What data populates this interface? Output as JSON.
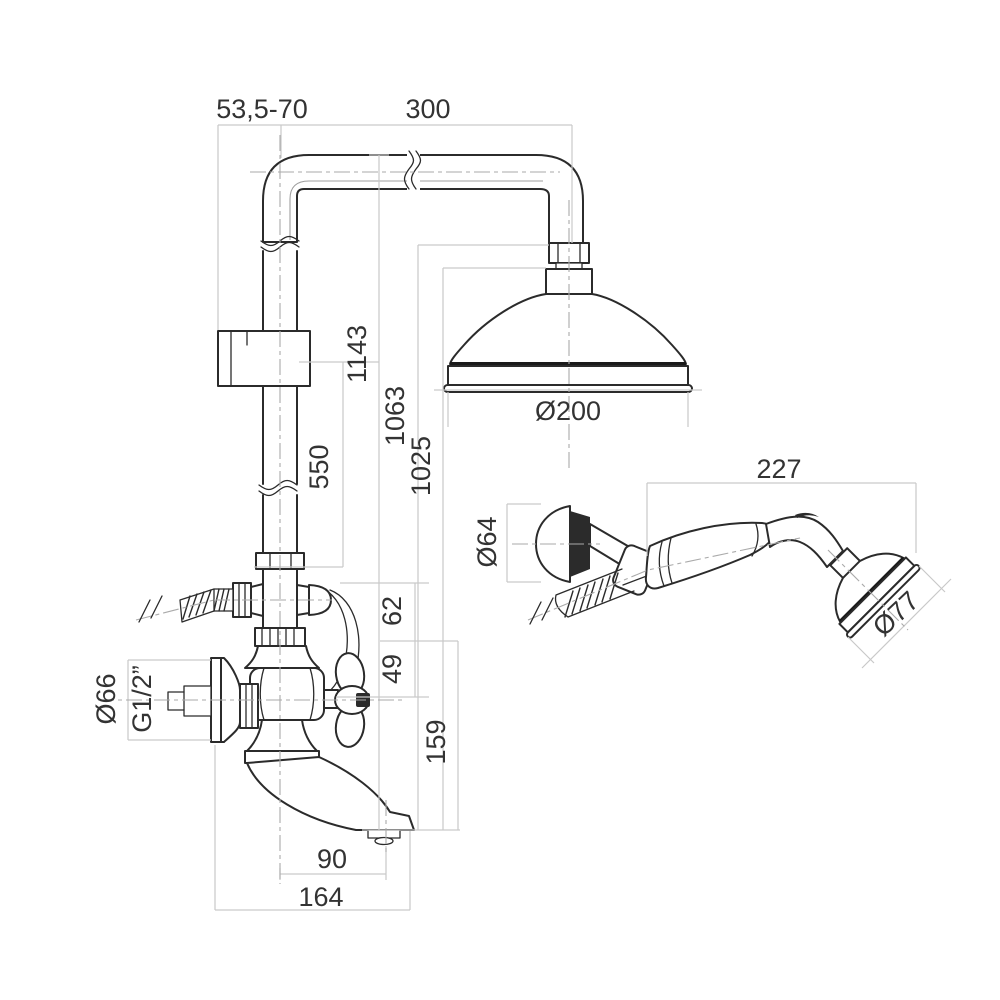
{
  "drawing": {
    "kind": "shower column technical dimension drawing",
    "background": "#ffffff",
    "stroke_color": "#2b2b2b",
    "dimension_line_color": "#c9c9c9",
    "centerline_color": "#aaaaaa",
    "text_color": "#333333"
  },
  "main_view": {
    "labels": {
      "wall_offset": "53,5-70",
      "arm_reach": "300",
      "height_to_top": "1143",
      "height_to_head_nut": "1063",
      "height_to_head": "1025",
      "bracket_to_valve": "550",
      "hose_outlet_drop": "62",
      "handle_drop": "49",
      "spout_outlet_drop": "159",
      "overhead_diameter": "Ø200",
      "flange_diameter": "Ø66",
      "thread_size": "G1/2”",
      "spout_reach": "90",
      "total_reach": "164"
    }
  },
  "hand_shower_view": {
    "labels": {
      "length": "227",
      "holder_diameter": "Ø64",
      "head_diameter": "Ø77"
    }
  }
}
